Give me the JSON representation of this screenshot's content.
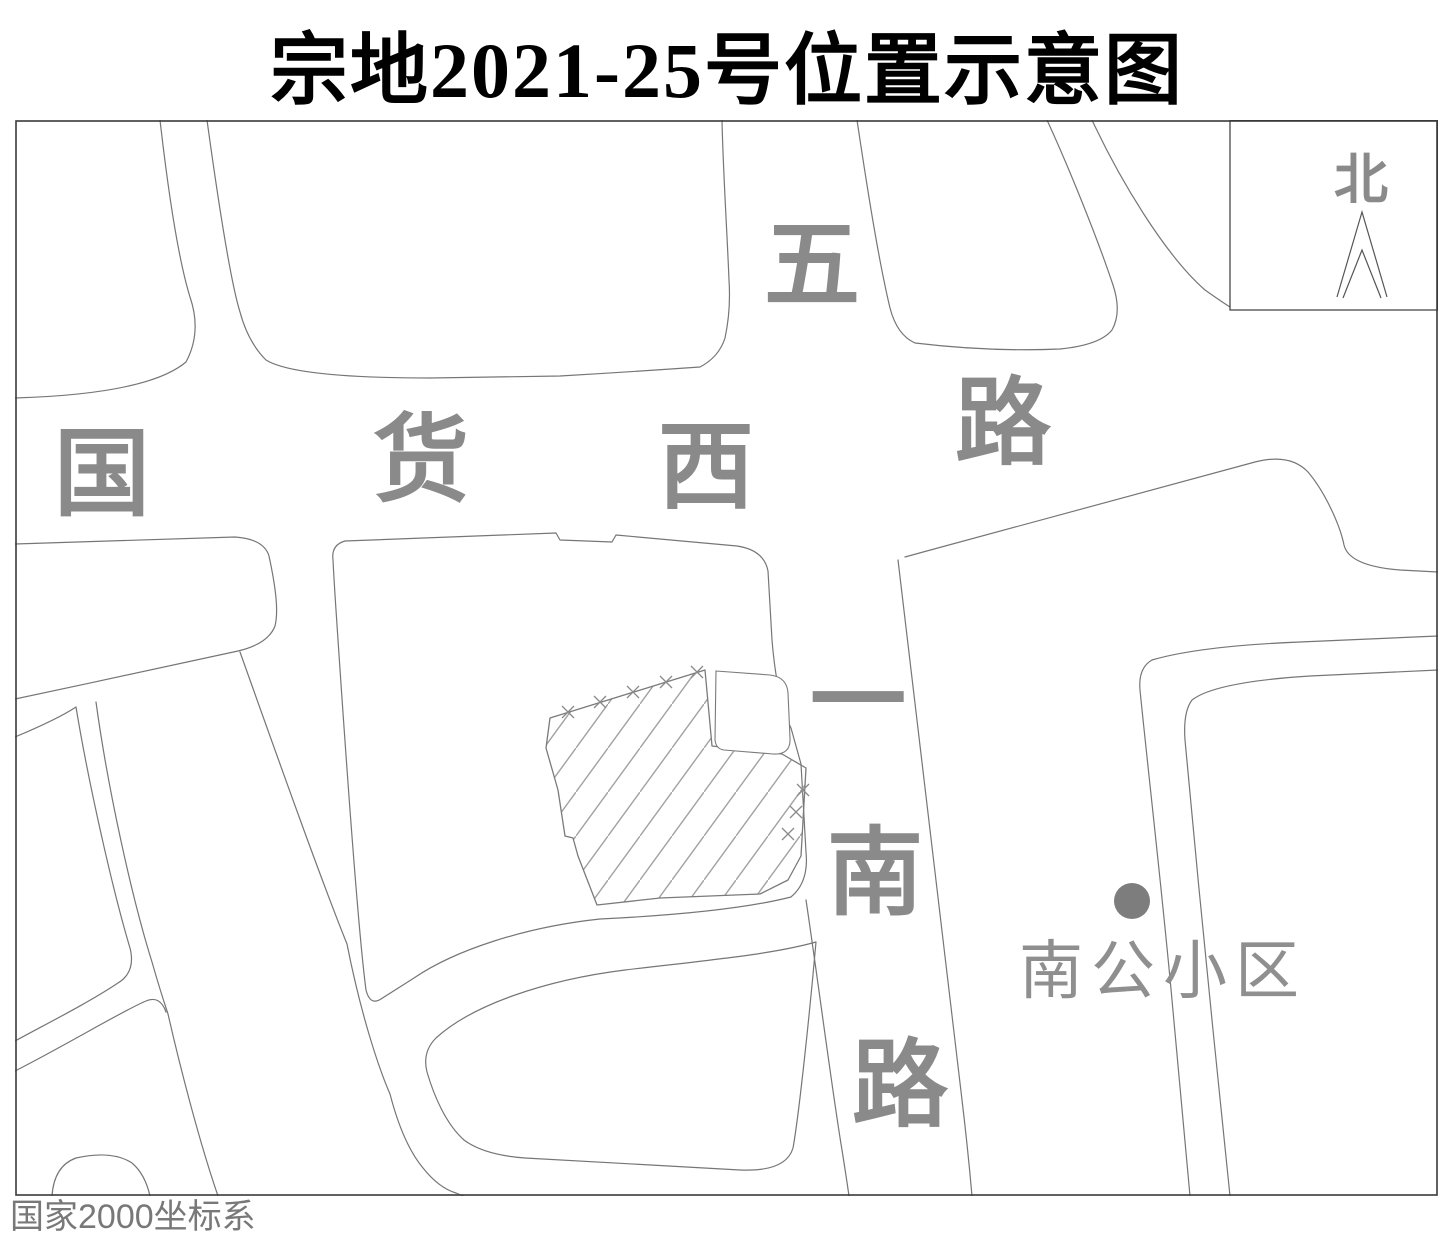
{
  "title": "宗地2021-25号位置示意图",
  "map": {
    "north_indicator": {
      "label": "北"
    },
    "roads": {
      "guohuo_xi_road": {
        "name": "国货西路",
        "chars": [
          "国",
          "货",
          "西",
          "路"
        ]
      },
      "wuyi_nan_road": {
        "name": "五一南路",
        "chars": [
          "五",
          "一",
          "南",
          "路"
        ]
      }
    },
    "parcel": {
      "id": "宗地2021-25号",
      "symbol": "diagonal-hatch-polygon-with-x-boundary-marks"
    },
    "poi": {
      "nangong_block": {
        "label": "南公小区",
        "marker": "filled-dot"
      }
    },
    "note": "国家2000坐标系",
    "colors": {
      "frame": "#3a3a3a",
      "line": "#767676",
      "hatch": "#a2a2a2",
      "label": "#8a8a8a",
      "title": "#000000",
      "note_text": "#787878",
      "background": "#ffffff"
    }
  }
}
